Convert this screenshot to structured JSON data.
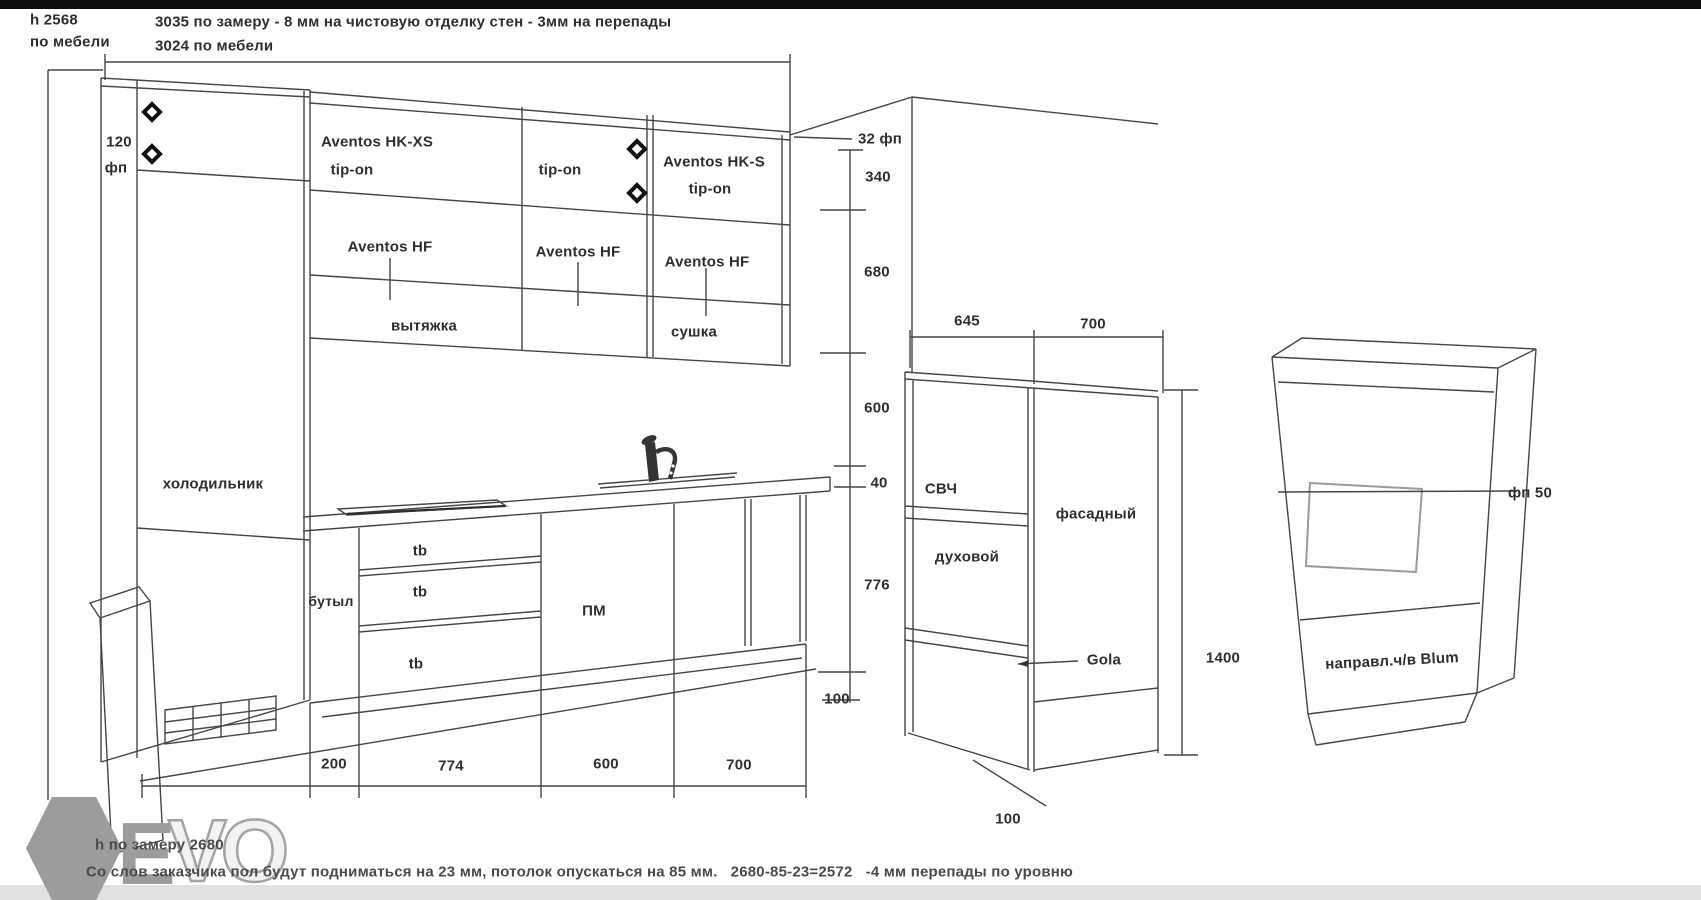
{
  "header": {
    "h_label": "h 2568",
    "h_sub": "по мебели",
    "note1": "3035 по замеру - 8 мм на чистовую отделку стен - 3мм на перепады",
    "note2": "3024 по мебели"
  },
  "left_column": {
    "filler_width": "120",
    "filler_code": "фп",
    "fridge_label": "холодильник"
  },
  "upper_cabinets": {
    "sec1_line1": "Aventos HK-XS",
    "sec1_line2": "tip-on",
    "sec2_line1": "tip-on",
    "sec3_line1": "Aventos HK-S",
    "sec3_line2": "tip-on",
    "hf1": "Aventos HF",
    "hf2": "Aventos HF",
    "hf3": "Aventos HF",
    "hood": "вытяжка",
    "dryer": "сушка"
  },
  "right_dimensions": {
    "top_filler": "32 фп",
    "d340": "340",
    "d680": "680",
    "d600": "600",
    "d40": "40",
    "d776": "776",
    "toe_kick": "100"
  },
  "base_cabinets": {
    "bottle": "бутыл",
    "drawer1": "tb",
    "drawer2": "tb",
    "drawer3": "tb",
    "dishwasher": "ПМ"
  },
  "bottom_dimensions": {
    "w1": "200",
    "w2": "774",
    "w3": "600",
    "w4": "700"
  },
  "tall_cabinet": {
    "depth": "645",
    "width": "700",
    "microwave": "СВЧ",
    "oven": "духовой",
    "front_panel": "фасадный",
    "front_height": "1400",
    "profile": "Gola",
    "plinth": "100"
  },
  "side_cabinet": {
    "filler": "фп 50",
    "note": "направл.ч/в Blum"
  },
  "footer": {
    "measured_height": "h по замеру 2680",
    "note": "Со слов заказчика пол будут подниматься на 23 мм, потолок опускаться на 85 мм.   2680-85-23=2572   -4 мм перепады по уровню"
  },
  "logo": {
    "letter_e": "E",
    "letters_vo": "VO"
  },
  "colors": {
    "line": "#454545",
    "text": "#2e2e2e",
    "logo_gray": "#9c9c9c",
    "top_bar": "#0e0e0e",
    "bottom_strip": "#e1e1e1"
  }
}
